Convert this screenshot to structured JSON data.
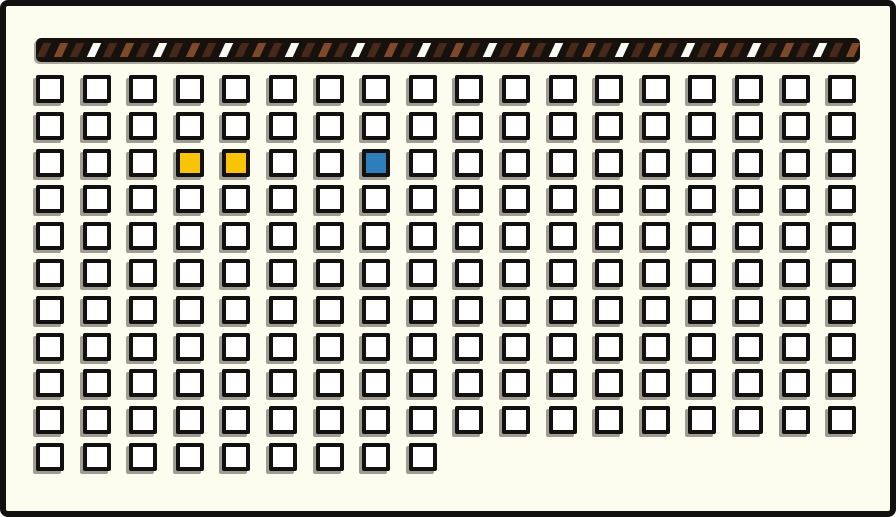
{
  "scene": {
    "description": "Grid panel of white square slots below a diagonally striped bar; two yellow slots and one blue slot highlighted in the third row",
    "background_color": "#FDFDEF",
    "outline_color": "#131110"
  },
  "striped_bar": {
    "base_color": "#16110D",
    "stripe_colors": {
      "dark_brown": "#47291A",
      "medium_brown": "#7E492B",
      "white": "#F8F8F5"
    },
    "stripe_sequence": [
      "dark_brown",
      "medium_brown",
      "dark_brown",
      "white"
    ],
    "stripe_count": 52
  },
  "grid": {
    "cells_per_row": [
      18,
      18,
      18,
      18,
      18,
      18,
      18,
      18,
      18,
      18,
      9
    ],
    "total_cells": 189,
    "cell_fill": "#FFFFFF",
    "cell_border": "#131110",
    "highlight_colors": {
      "yellow": "#F9C406",
      "blue": "#2E7EBC"
    },
    "highlighted_cells": [
      {
        "row": 3,
        "col": 4,
        "color_name": "yellow",
        "color": "#F9C406"
      },
      {
        "row": 3,
        "col": 5,
        "color_name": "yellow",
        "color": "#F9C406"
      },
      {
        "row": 3,
        "col": 8,
        "color_name": "blue",
        "color": "#2E7EBC"
      }
    ]
  }
}
